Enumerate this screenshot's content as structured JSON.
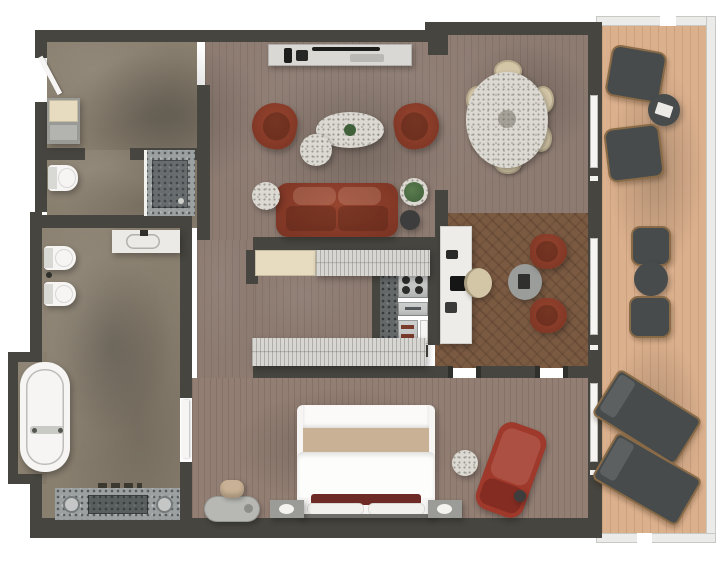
{
  "scene_type": "luxury-suite-floor-plan-top-down-render",
  "visible_text": [],
  "colors": {
    "wall": "#46453f",
    "stone": "#897f6f",
    "wood": "#8d7b71",
    "wood2": "#927e73",
    "hb": "#7b5a42",
    "deck": "#dbb08d",
    "railing": "#ebebe9",
    "railEdge": "#c9c9c4",
    "leather": "#96442e",
    "leatherDk": "#7a3323",
    "chaise": "#9e392b",
    "chaiseDk": "#842c22",
    "beige": "#d3c6a7",
    "marble": "#dcd9d2",
    "steel": "#c4c5c5",
    "steelDk": "#66696b",
    "wardrobe": "#d7d6d2",
    "wardBeige": "#e7dcc0",
    "desk": "#edece8",
    "fixture": "#f6f5f3",
    "stoneCtr": "#9ba0a1",
    "stoneCtrDk": "#5f6467",
    "maroon": "#6e2b26",
    "throw": "#c8b194",
    "balc": "#474b4b",
    "balcFrame": "#8a6b48",
    "plant": "#40603a",
    "tdark": "#3c3d3c",
    "bench": "#b7b8b4"
  },
  "rooms": {
    "foyer": {
      "items": [
        "entry-door",
        "storage-cabinet"
      ]
    },
    "powder_room": {
      "items": [
        "toilet",
        "stone-shower"
      ]
    },
    "bathroom": {
      "items": [
        "marble-vanity",
        "toilet",
        "bidet",
        "freestanding-bathtub",
        "double-stone-vanity",
        "door"
      ]
    },
    "living_room": {
      "items": [
        "media-console",
        "armchair-left",
        "armchair-right",
        "oval-marble-coffee-table",
        "round-marble-coffee-table",
        "leather-sofa",
        "round-side-table",
        "potted-plant",
        "dark-side-table"
      ]
    },
    "dining_room": {
      "items": [
        "oval-marble-dining-table",
        "dining-chair",
        "dining-chair",
        "dining-chair",
        "dining-chair",
        "dining-chair",
        "dining-chair"
      ]
    },
    "study": {
      "items": [
        "white-desk",
        "desk-chair",
        "lounge-armchair",
        "lounge-armchair",
        "round-table"
      ]
    },
    "kitchenette": {
      "items": [
        "stone-counter",
        "cooktop",
        "drawer-unit",
        "oven",
        "cabinet"
      ]
    },
    "dressing_corridor": {
      "items": [
        "wardrobe-beige",
        "wardrobe-ribbed",
        "wardrobe-lower"
      ]
    },
    "bedroom": {
      "items": [
        "king-bed",
        "nightstand-left",
        "nightstand-right",
        "bench",
        "pouf",
        "red-chaise-lounge",
        "marble-side-table"
      ]
    },
    "balcony": {
      "items": [
        "lounge-chair",
        "lounge-chair",
        "round-table",
        "bistro-chair",
        "bistro-chair",
        "bistro-table",
        "sun-lounger",
        "sun-lounger"
      ]
    }
  }
}
